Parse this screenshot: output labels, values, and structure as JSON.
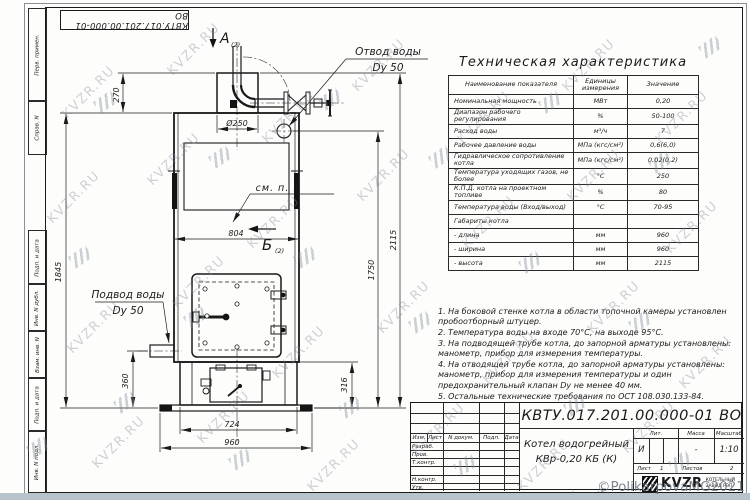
{
  "watermark": {
    "text": "KVZR.RU",
    "copyright": "©PolikarpovaMG2021"
  },
  "stamp_top": "КВТУ.017.201.00.000-01 ВО",
  "frame_left": {
    "top": [
      "Перв. примен.",
      "Справ. N"
    ],
    "bottom": [
      "Подп. и дата",
      "Инв. N дубл.",
      "Взам. инв. N",
      "Подп. и дата",
      "Инв. N подл."
    ]
  },
  "drawing": {
    "view_a": "А",
    "view_a_sub": "(2)",
    "view_b": "Б",
    "view_b_sub": "(2)",
    "see_note": "см. п. 1",
    "outlet_label_1": "Отвод воды",
    "outlet_label_2": "Dy 50",
    "inlet_label_1": "Подвод воды",
    "inlet_label_2": "Dy 50",
    "dims": {
      "d270": "270",
      "d250": "Ø250",
      "d804": "804",
      "d1845": "1845",
      "d1750": "1750",
      "d2115": "2115",
      "d360": "360",
      "d316": "316",
      "d724": "724",
      "d960": "960"
    }
  },
  "tech_table": {
    "title": "Техническая характеристика",
    "headers": [
      "Наименование показателя",
      "Единицы измерения",
      "Значение"
    ],
    "rows": [
      {
        "name": "Номинальная мощность",
        "units": "МВт",
        "value": "0,20"
      },
      {
        "name": "Диапазон рабочего регулирования",
        "units": "%",
        "value": "50-100"
      },
      {
        "name": "Расход воды",
        "units": "м³/ч",
        "value": "7"
      },
      {
        "name": "Рабочее давление воды",
        "units": "МПа (кгс/см²)",
        "value": "0,6(6,0)"
      },
      {
        "name": "Гидравлическое сопротивление котла",
        "units": "МПа (кгс/см²)",
        "value": "0,02(0,2)"
      },
      {
        "name": "Температура уходящих газов, не более",
        "units": "°С",
        "value": "250"
      },
      {
        "name": "К.П.Д. котла на проектном топливе",
        "units": "%",
        "value": "80"
      },
      {
        "name": "Температура воды (Вход/выход)",
        "units": "°С",
        "value": "70-95"
      },
      {
        "name": "Габариты котла",
        "units": "",
        "value": ""
      },
      {
        "name": "- длина",
        "units": "мм",
        "value": "960"
      },
      {
        "name": "- ширина",
        "units": "мм",
        "value": "960"
      },
      {
        "name": "- высота",
        "units": "мм",
        "value": "2115"
      }
    ]
  },
  "notes": [
    "1. На боковой стенке котла в области топочной камеры установлен пробоотборный штуцер.",
    "2. Температура воды на входе 70°С, на выходе 95°С.",
    "3. На подводящей трубе котла, до запорной арматуры установлены: манометр, прибор для измерения температуры.",
    "4. На отводящей трубе котла, до запорной арматуры установлены: манометр, прибор для измерения температуры и один предохранительный клапан Dy не менее 40 мм.",
    "5. Остальные технические требования по ОСТ 108.030.133-84."
  ],
  "title_block": {
    "doc_number": "КВТУ.017.201.00.000-01 ВО",
    "name_line1": "Котел водогрейный",
    "name_line2": "КВр-0,20 КБ (К)",
    "header_cells": [
      "Изм.",
      "Лист",
      "N докум.",
      "Подп.",
      "Дата"
    ],
    "row_labels": [
      "Разраб.",
      "Пров.",
      "Т.контр.",
      "",
      "Н.контр.",
      "Утв."
    ],
    "lit_label": "Лит.",
    "mass_label": "Масса",
    "scale_label": "Масштаб",
    "lit_value": "И",
    "mass_value": "-",
    "scale_value": "1:10",
    "sheet_label": "Лист",
    "sheet_value": "1",
    "sheets_label": "Листов",
    "sheets_value": "2",
    "logo_text": "KVZR",
    "logo_sub1": "КОТЕЛЬНЫЙ",
    "logo_sub2": "ЗАВОД РЭП",
    "format_label": "Формат А3"
  }
}
